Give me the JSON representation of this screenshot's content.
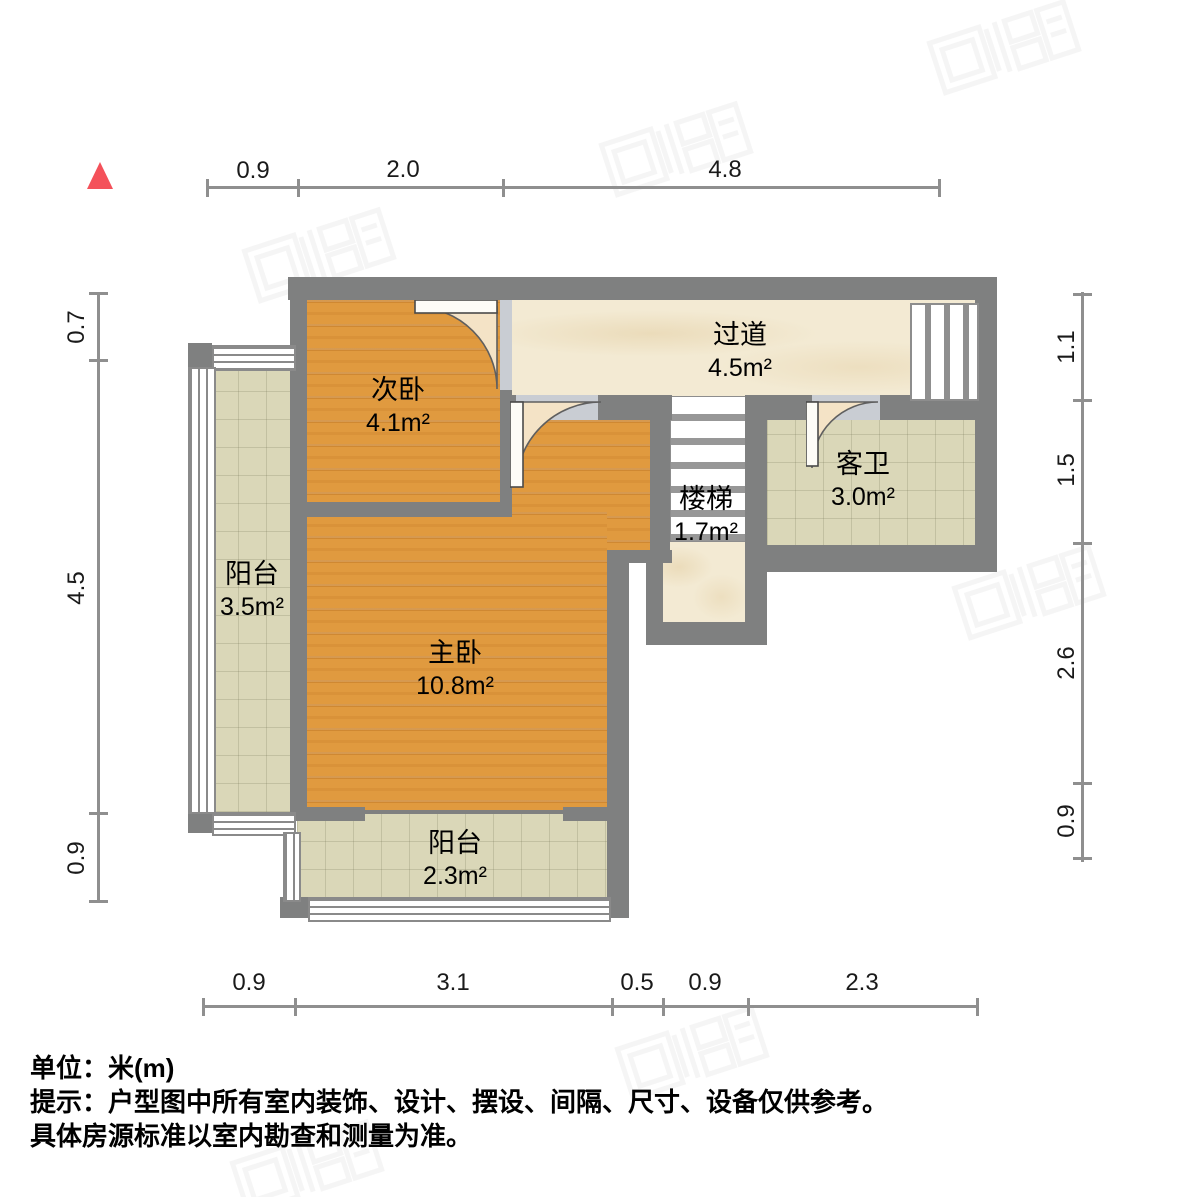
{
  "plan": {
    "rooms": [
      {
        "name": "次卧",
        "area": "4.1m²"
      },
      {
        "name": "过道",
        "area": "4.5m²"
      },
      {
        "name": "客卫",
        "area": "3.0m²"
      },
      {
        "name": "楼梯",
        "area": "1.7m²"
      },
      {
        "name": "主卧",
        "area": "10.8m²"
      },
      {
        "name": "阳台",
        "area": "3.5m²"
      },
      {
        "name": "阳台",
        "area": "2.3m²"
      }
    ],
    "dimensions": {
      "top": [
        "0.9",
        "2.0",
        "4.8"
      ],
      "bottom": [
        "0.9",
        "3.1",
        "0.5",
        "0.9",
        "2.3"
      ],
      "left": [
        "0.7",
        "4.5",
        "0.9"
      ],
      "right": [
        "1.1",
        "1.5",
        "2.6",
        "0.9"
      ]
    }
  },
  "footer": {
    "unit_label": "单位：米(m)",
    "tip_line": "提示：户型图中所有室内装饰、设计、摆设、间隔、尺寸、设备仅供参考。",
    "note_line": "具体房源标准以室内勘查和测量为准。"
  },
  "icons": {
    "north_indicator": "red-triangle-north-marker",
    "watermark": "faint-realtor-logo-stamp"
  },
  "colors": {
    "wall": "#7f8080",
    "wood_floor": "#e09a3f",
    "tile_floor": "#dad7b8",
    "marble_floor": "#f3ead3",
    "dimension_line": "#8f8f8f",
    "north_marker": "#f4515a",
    "door_swing": "#f4e3c6"
  }
}
